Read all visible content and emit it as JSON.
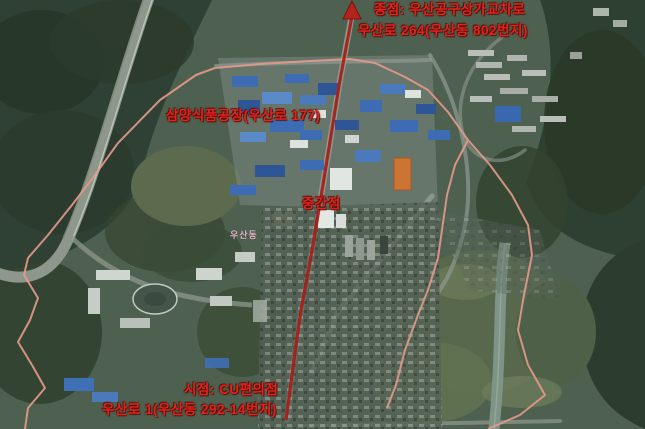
{
  "map": {
    "labels": {
      "end_point": {
        "line1": "종점: 우산공구상가교차로",
        "line2": "우산로 264(우산동 802번지)"
      },
      "factory": "삼양식품공장(우산로 177)",
      "mid_point": "중간점",
      "district": "우산동",
      "start_point": {
        "line1": "시점: CU편의점",
        "line2": "우산로 1(우산동 292-14번지)"
      }
    },
    "colors": {
      "route_red": "#a8201a",
      "label_red": "#e4231d",
      "boundary_pink": "#e59a8b",
      "district_label": "#e3b9c9"
    }
  }
}
